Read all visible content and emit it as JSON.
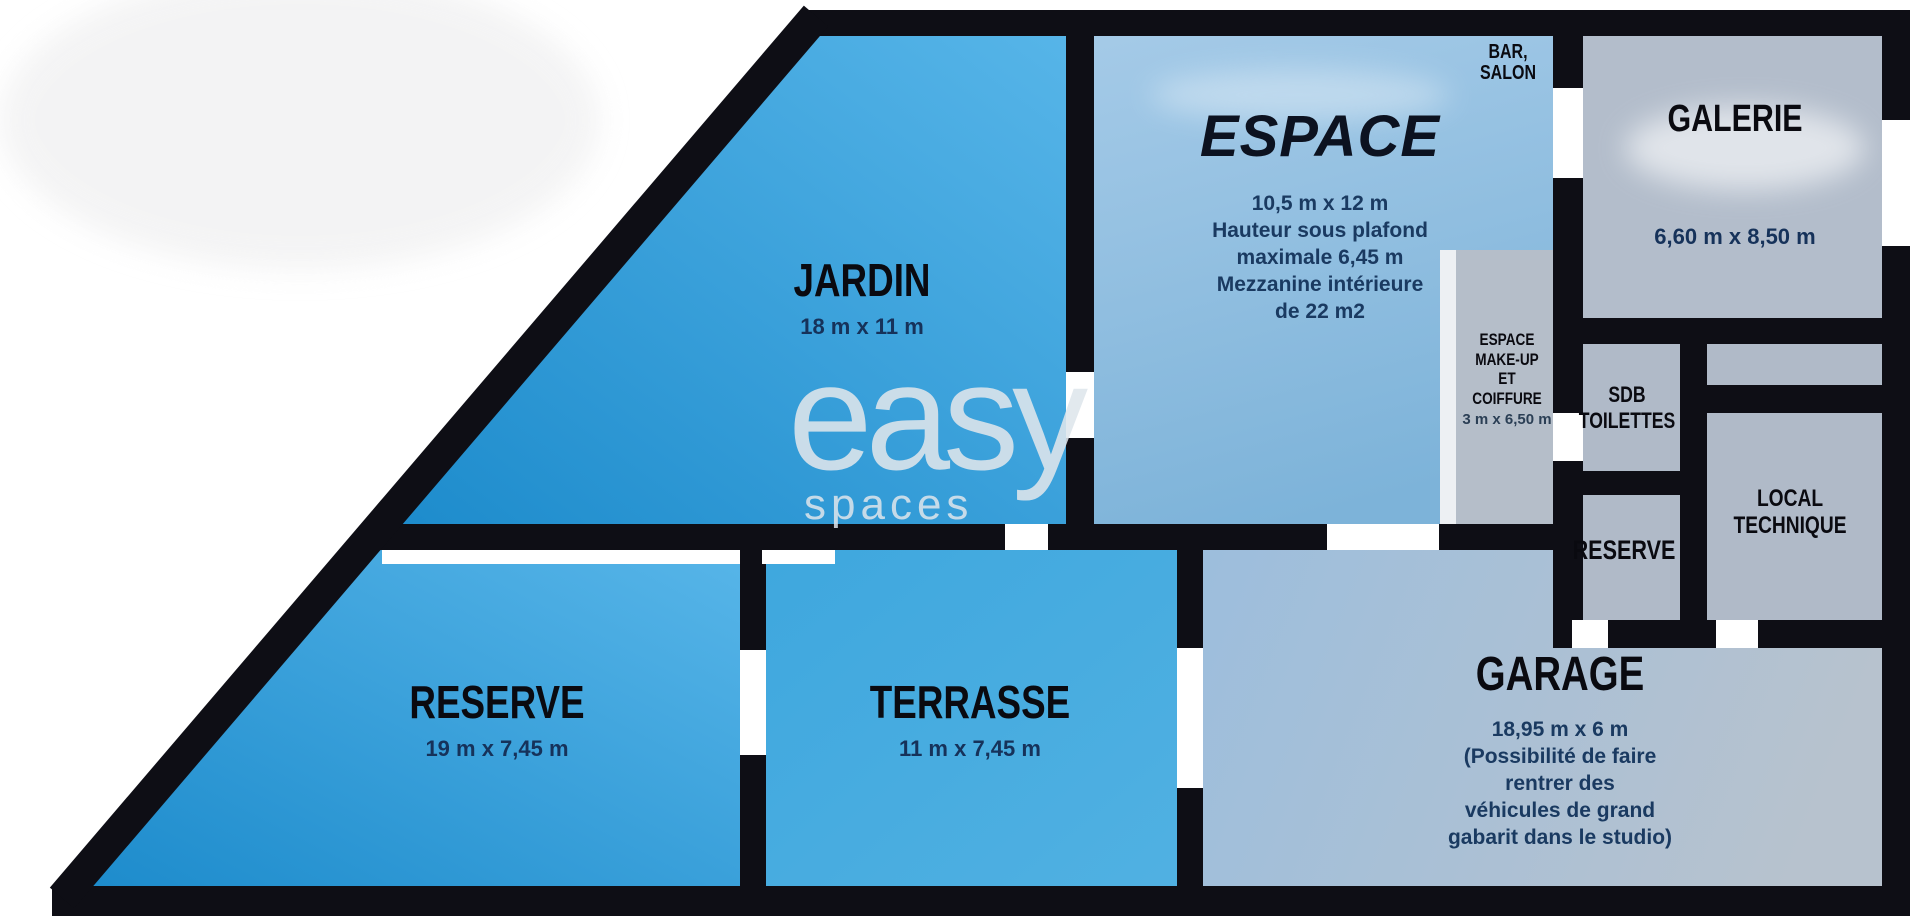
{
  "watermark": {
    "line1": "easy",
    "line2": "spaces"
  },
  "rooms": {
    "jardin": {
      "name": "JARDIN",
      "dims": "18 m x 11 m"
    },
    "espace": {
      "name": "ESPACE",
      "lines": [
        "10,5 m x 12 m",
        "Hauteur sous plafond",
        "maximale 6,45 m",
        "Mezzanine intérieure",
        "de 22 m2"
      ]
    },
    "bar_salon": {
      "lines": [
        "BAR,",
        "SALON"
      ]
    },
    "galerie": {
      "name": "GALERIE",
      "dims": "6,60 m x 8,50 m"
    },
    "makeup": {
      "lines": [
        "ESPACE",
        "MAKE-UP",
        "ET",
        "COIFFURE"
      ],
      "dims": "3 m x 6,50 m"
    },
    "sdb": {
      "lines": [
        "SDB",
        "TOILETTES"
      ]
    },
    "reserve_right": {
      "name": "RESERVE"
    },
    "local_technique": {
      "lines": [
        "LOCAL",
        "TECHNIQUE"
      ]
    },
    "reserve_left": {
      "name": "RESERVE",
      "dims": "19 m x 7,45 m"
    },
    "terrasse": {
      "name": "TERRASSE",
      "dims": "11 m x 7,45 m"
    },
    "garage": {
      "name": "GARAGE",
      "lines": [
        "18,95 m x 6 m",
        "(Possibilité de faire",
        "rentrer des",
        "véhicules de grand",
        "gabarit dans le studio)"
      ]
    }
  },
  "colors": {
    "wall": "#0e0e15",
    "room_blue_light": "#58b5e8",
    "room_blue_deep": "#1e8ed1",
    "espace_blue": "#8fc0e2",
    "service_gray": "#b2bcca",
    "garage_gray_blue": "#a9c1d9",
    "title_text": "#0a0a10",
    "dims_text": "#16325a",
    "watermark": "#dfe6ec"
  }
}
